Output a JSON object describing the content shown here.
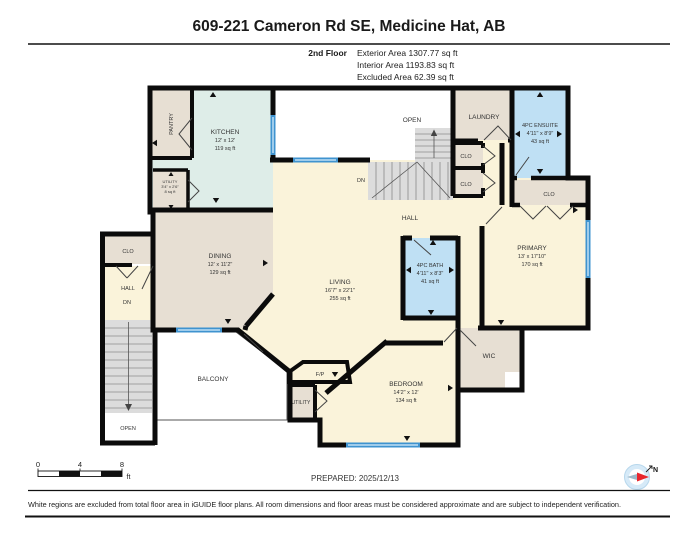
{
  "header": {
    "title": "609-221 Cameron Rd SE, Medicine Hat, AB",
    "floor_label": "2nd Floor",
    "stats": [
      "Exterior Area 1307.77 sq ft",
      "Interior Area 1193.83 sq ft",
      "Excluded Area 62.39 sq ft"
    ]
  },
  "rooms": {
    "kitchen": {
      "name": "KITCHEN",
      "dims": "12' x 12'",
      "area": "119 sq ft"
    },
    "pantry": {
      "name": "PANTRY"
    },
    "utility_upper": {
      "name": "UTILITY",
      "dims": "3'4\" x 2'6\"",
      "area": "8 sq ft"
    },
    "dining": {
      "name": "DINING",
      "dims": "12' x 11'2\"",
      "area": "129 sq ft"
    },
    "living": {
      "name": "LIVING",
      "dims": "16'7\" x 22'1\"",
      "area": "255 sq ft"
    },
    "open_upper": {
      "name": "OPEN"
    },
    "hall_main": {
      "name": "HALL"
    },
    "dn_main": {
      "name": "DN"
    },
    "laundry": {
      "name": "LAUNDRY"
    },
    "closet_hall_a": {
      "name": "CLO"
    },
    "closet_hall_b": {
      "name": "CLO"
    },
    "ensuite": {
      "name": "4PC ENSUITE",
      "dims": "4'11\" x 8'9\"",
      "area": "43 sq ft"
    },
    "closet_primary": {
      "name": "CLO"
    },
    "primary": {
      "name": "PRIMARY",
      "dims": "13' x 17'10\"",
      "area": "170 sq ft"
    },
    "bath": {
      "name": "4PC BATH",
      "dims": "4'11\" x 8'3\"",
      "area": "41 sq ft"
    },
    "wic": {
      "name": "WIC"
    },
    "bedroom": {
      "name": "BEDROOM",
      "dims": "14'2\" x 12'",
      "area": "134 sq ft"
    },
    "balcony": {
      "name": "BALCONY"
    },
    "fireplace": {
      "name": "F/P"
    },
    "utility_lower": {
      "name": "UTILITY"
    },
    "stair_closet": {
      "name": "CLO"
    },
    "stair_hall": {
      "name": "HALL"
    },
    "stair_dn": {
      "name": "DN"
    },
    "open_lower": {
      "name": "OPEN"
    }
  },
  "scale_bar": {
    "ticks": [
      "0",
      "4",
      "8"
    ],
    "unit": "ft"
  },
  "prepared": "PREPARED: 2025/12/13",
  "compass": {
    "label": "N"
  },
  "footer": "White regions are excluded from total floor area in iGUIDE floor plans. All room dimensions and floor areas must be considered approximate and are subject to independent verification.",
  "colors": {
    "wall": "#0b0b0b",
    "interior_cream": "#FAF3DA",
    "room_tan": "#E7DFD3",
    "kitchen_teal": "#DEEDE8",
    "bath_blue": "#BFE0F4",
    "window_blue": "#3F93CF",
    "stairs_gray": "#DCDCDC",
    "excluded_white": "#FFFFFF",
    "compass_red": "#E8262D"
  }
}
